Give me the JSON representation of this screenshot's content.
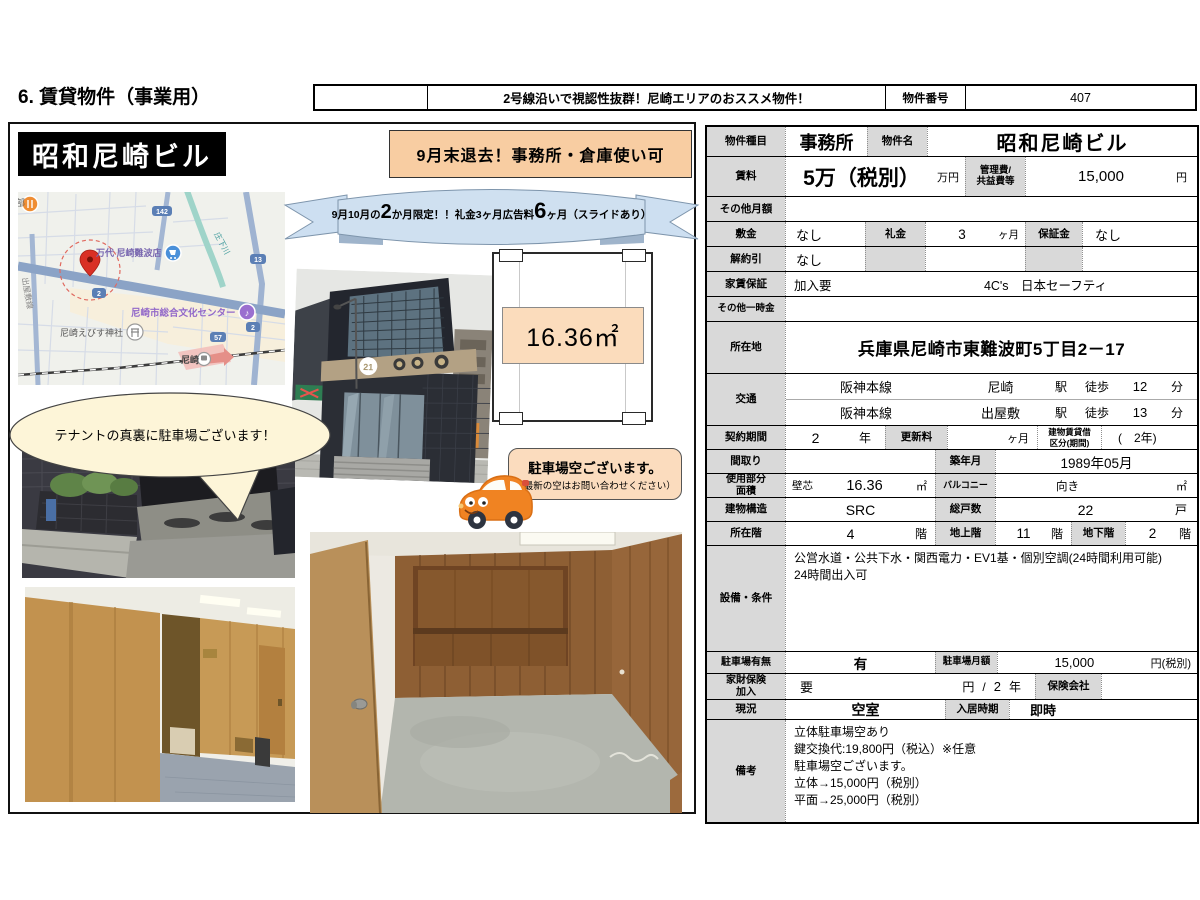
{
  "header": {
    "section_title": "6. 賃貸物件（事業用）",
    "catch_copy": "2号線沿いで視認性抜群！尼崎エリアのおススメ物件！",
    "property_no_label": "物件番号",
    "property_no": "407"
  },
  "left": {
    "building_name": "昭和尼崎ビル",
    "highlight_banner": "9月末退去！事務所・倉庫使い可",
    "ribbon": {
      "pre": "9月10月の",
      "big1": "2",
      "mid": "か月限定！！礼金3ヶ月広告料",
      "big2": "6",
      "post": "ヶ月（スライドあり）"
    },
    "floorplan": {
      "area": "16.36㎡"
    },
    "bubble_parking_back": "テナントの真裏に駐車場ございます！",
    "bubble_parking": {
      "line1": "駐車場空ございます。",
      "line2": "（最新の空はお問い合わせください）"
    },
    "map": {
      "labels": {
        "corner": "部",
        "store": "万代 尼崎難波店",
        "culture_center": "尼崎市総合文化センター",
        "shrine": "尼崎えびす神社",
        "station": "尼崎",
        "road_left": "出屋敷線",
        "river": "庄下川"
      },
      "routes": {
        "r142": "142",
        "r2a": "2",
        "r13": "13",
        "r57": "57",
        "r2b": "2"
      }
    }
  },
  "table": {
    "type": {
      "label": "物件種目",
      "value": "事務所",
      "name_label": "物件名",
      "name": "昭和尼崎ビル"
    },
    "rent": {
      "label": "賃料",
      "value": "5万（税別）",
      "unit": "万円",
      "kanri_label": "管理費/\n共益費等",
      "kanri": "15,000",
      "kanri_unit": "円"
    },
    "other_monthly": {
      "label": "その他月額"
    },
    "deposit": {
      "label": "敷金",
      "value": "なし",
      "key_label": "礼金",
      "key": "3",
      "key_unit": "ヶ月",
      "hosho_label": "保証金",
      "hosho": "なし"
    },
    "kaiyaku": {
      "label": "解約引",
      "value": "なし"
    },
    "guarantee": {
      "label": "家賃保証",
      "value": "加入要",
      "company": "4C's　日本セーフティ"
    },
    "other_onetime": {
      "label": "その他一時金"
    },
    "address": {
      "label": "所在地",
      "value": "兵庫県尼崎市東難波町5丁目2－17"
    },
    "access": {
      "label": "交通",
      "lines": [
        {
          "line": "阪神本線",
          "station": "尼崎",
          "sta": "駅",
          "walk": "徒歩",
          "min": "12",
          "unit": "分"
        },
        {
          "line": "阪神本線",
          "station": "出屋敷",
          "sta": "駅",
          "walk": "徒歩",
          "min": "13",
          "unit": "分"
        }
      ]
    },
    "contract": {
      "label": "契約期間",
      "value": "2",
      "unit": "年",
      "renewal_label": "更新料",
      "renewal_unit": "ヶ月",
      "kubun_label": "建物賃貸借\n区分(期間)",
      "kubun": "(　2年)"
    },
    "madori": {
      "label": "間取り",
      "built_label": "築年月",
      "built": "1989年05月"
    },
    "area": {
      "label": "使用部分\n面積",
      "method": "壁芯",
      "value": "16.36",
      "unit": "㎡",
      "balcony_label": "バルコニー",
      "muki": "向き",
      "balcony_unit": "㎡"
    },
    "structure": {
      "label": "建物構造",
      "value": "SRC",
      "units_label": "総戸数",
      "units": "22",
      "units_unit": "戸"
    },
    "floor": {
      "label": "所在階",
      "value": "4",
      "unit": "階",
      "above_label": "地上階",
      "above": "11",
      "above_unit": "階",
      "below_label": "地下階",
      "below": "2",
      "below_unit": "階"
    },
    "facilities": {
      "label": "設備・条件",
      "value": "公営水道・公共下水・関西電力・EV1基・個別空調(24時間利用可能)\n24時間出入可"
    },
    "parking": {
      "label": "駐車場有無",
      "value": "有",
      "fee_label": "駐車場月額",
      "fee": "15,000",
      "fee_unit": "円(税別)"
    },
    "insurance": {
      "label": "家財保険\n加入",
      "value": "要",
      "yen": "円",
      "slash": "/",
      "term": "2",
      "year": "年",
      "company_label": "保険会社"
    },
    "status": {
      "label": "現況",
      "value": "空室",
      "movein_label": "入居時期",
      "movein": "即時"
    },
    "remarks": {
      "label": "備考",
      "value": "立体駐車場空あり\n鍵交換代:19,800円（税込）※任意\n駐車場空ございます。\n立体→15,000円（税別）\n平面→25,000円（税別）"
    }
  }
}
